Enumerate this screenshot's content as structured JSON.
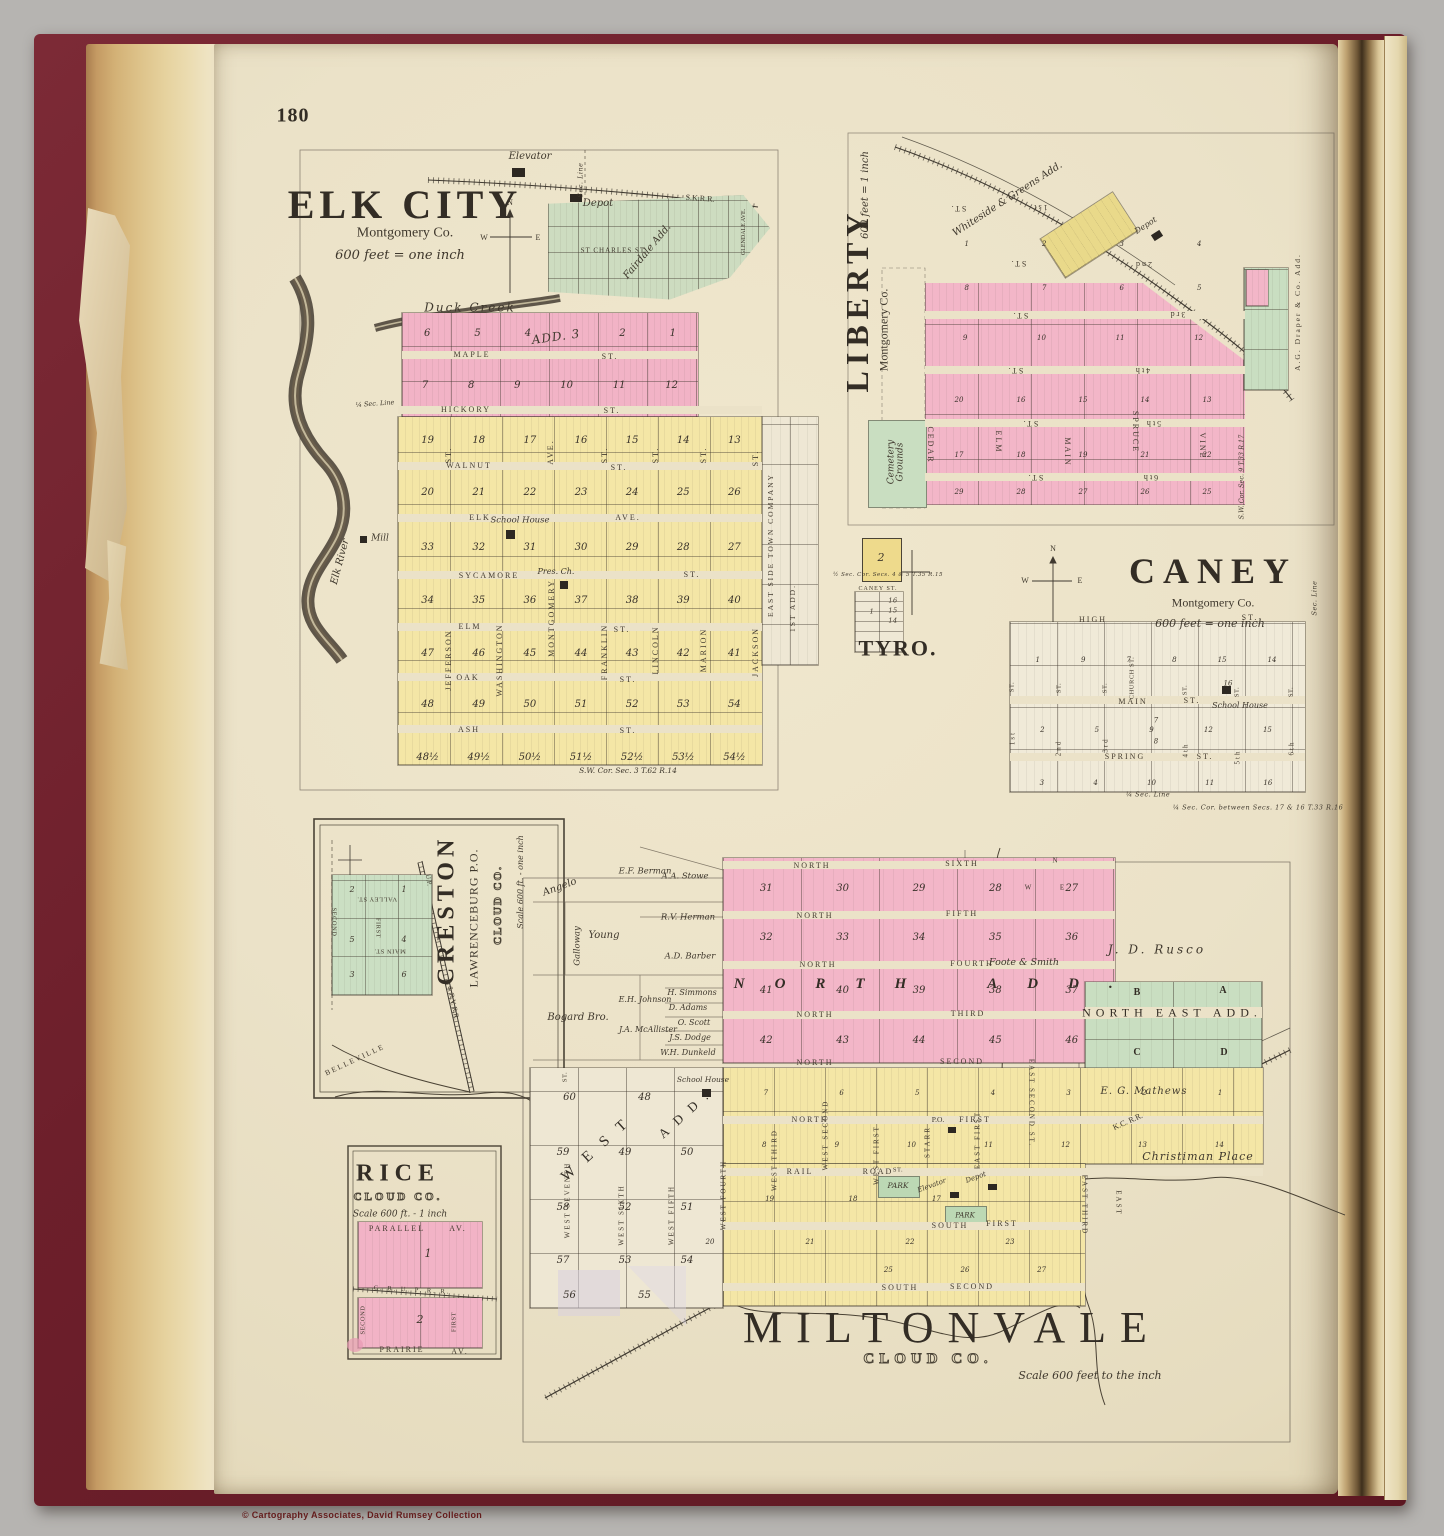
{
  "page": {
    "number": "180",
    "copyright": "© Cartography Associates, David Rumsey Collection"
  },
  "elkcity": {
    "title": "ELK CITY",
    "county": "Montgomery Co.",
    "scale": "600 feet = one inch",
    "compass": {
      "n": "N",
      "w": "W",
      "e": "E"
    },
    "rr": "S.K.R.R.",
    "elevator": "Elevator",
    "depot": "Depot",
    "duck_creek": "Duck  Creek",
    "elk_river": "Elk River",
    "mill": "Mill",
    "add3": "ADD. 3",
    "sec_line": "Sec. Line",
    "qtr_sec": "¼ Sec. Line",
    "fairdale": "Fairdale Add.",
    "st_charles": "ST CHARLES ST.",
    "glendale": "GLENDALE AVE.",
    "school": "School House",
    "church": "Pres. Ch.",
    "east_side": "EAST SIDE TOWN COMPANY",
    "first_add": "1ST ADD.",
    "corner": "S.W. Cor. Sec. 3  T.62 R.14",
    "streets_h": [
      {
        "n": "MAPLE",
        "t": "ST."
      },
      {
        "n": "HICKORY",
        "t": "ST."
      },
      {
        "n": "WALNUT",
        "t": "ST."
      },
      {
        "n": "ELK",
        "t": "AVE."
      },
      {
        "n": "SYCAMORE",
        "t": "ST."
      },
      {
        "n": "ELM",
        "t": "ST."
      },
      {
        "n": "OAK",
        "t": "ST."
      },
      {
        "n": "ASH",
        "t": "ST."
      }
    ],
    "streets_v": [
      "JEFFERSON",
      "WASHINGTON",
      "MONTGOMERY",
      "FRANKLIN",
      "LINCOLN",
      "MARION",
      "JACKSON"
    ],
    "streets_v_upper": [
      "ST.",
      "AVE.",
      "ST.",
      "ST.",
      "ST.",
      "ST."
    ],
    "blocks_pink": [
      [
        "6",
        "5",
        "4",
        "",
        "2",
        "1"
      ],
      [
        "7",
        "8",
        "9",
        "10",
        "11",
        "12"
      ]
    ],
    "blocks_yellow": [
      [
        "19",
        "18",
        "17",
        "16",
        "15",
        "14",
        "13"
      ],
      [
        "20",
        "21",
        "22",
        "23",
        "24",
        "25",
        "26"
      ],
      [
        "33",
        "32",
        "31",
        "30",
        "29",
        "28",
        "27"
      ],
      [
        "34",
        "35",
        "36",
        "37",
        "38",
        "39",
        "40"
      ],
      [
        "47",
        "46",
        "45",
        "44",
        "43",
        "42",
        "41"
      ],
      [
        "48",
        "49",
        "50",
        "51",
        "52",
        "53",
        "54"
      ],
      [
        "48½",
        "49½",
        "50½",
        "51½",
        "52½",
        "53½",
        "54½"
      ]
    ]
  },
  "liberty": {
    "title": "LIBERTY",
    "county": "Montgomery Co.",
    "scale": "600 feet = 1 inch",
    "whiteside": "Whiteside & Greens Add.",
    "depot": "Depot",
    "cemetery": "Cemetery\nGrounds",
    "draper": "A.G. Draper & Co. Add.",
    "corner": "S.W. Cor. Sec. 9  T.33 R.17",
    "streets_h": [
      {
        "n": "1st",
        "t": "ST."
      },
      {
        "n": "2nd",
        "t": "ST."
      },
      {
        "n": "3rd",
        "t": "ST."
      },
      {
        "n": "4th",
        "t": "ST."
      },
      {
        "n": "5th",
        "t": "ST."
      },
      {
        "n": "6th",
        "t": "ST."
      }
    ],
    "streets_v": [
      "CEDAR",
      "ELM",
      "MAIN",
      "SPRUCE",
      "VINE"
    ],
    "blocks": [
      [
        "1",
        "2",
        "3",
        "4"
      ],
      [
        "8",
        "7",
        "6",
        "5"
      ],
      [
        "9",
        "10",
        "11",
        "12"
      ],
      [
        "20",
        "16",
        "15",
        "14",
        "13"
      ],
      [
        "17",
        "18",
        "19",
        "21",
        "22"
      ],
      [
        "29",
        "28",
        "27",
        "26",
        "25"
      ]
    ]
  },
  "tyro": {
    "title": "TYRO.",
    "street": "CANEY ST.",
    "corner": "½ Sec. Cor. Secs. 4 & 5  T.35 R.15",
    "block": "2",
    "lots": [
      "1",
      "16",
      "15",
      "14"
    ]
  },
  "caney": {
    "title": "CANEY",
    "county": "Montgomery Co.",
    "scale": "600 feet = one inch",
    "compass": {
      "n": "N",
      "w": "W",
      "e": "E"
    },
    "school": "School House",
    "sec_line": "Sec. Line",
    "qtr_line": "¼ Sec. Line",
    "corner": "¼ Sec. Cor. between Secs. 17 & 16  T.33 R.16",
    "st_label": "ST.",
    "church_st": "CHURCH ST.",
    "streets_h": [
      {
        "n": "HIGH",
        "t": "ST."
      },
      {
        "n": "MAIN",
        "t": "ST."
      },
      {
        "n": "SPRING",
        "t": "ST."
      }
    ],
    "streets_v": [
      "1st",
      "2nd",
      "3rd",
      "4th",
      "5th",
      "6th"
    ],
    "blocks": [
      [
        "1",
        "9",
        "7",
        "8",
        "15",
        "14"
      ],
      [
        "2",
        "5",
        "9",
        "12",
        "15"
      ],
      [
        "3",
        "4",
        "10",
        "11",
        "16"
      ]
    ],
    "extra_blocks": [
      "16",
      "7",
      "8"
    ]
  },
  "creston": {
    "title": "CRESTON",
    "subtitle": "LAWRENCEBURG P.O.",
    "county": "CLOUD CO.",
    "scale": "Scale 600 ft. - one inch",
    "streets": {
      "valley": "VALLEY ST.",
      "main": "MAIN ST.",
      "first": "FIRST",
      "second": "SECOND"
    },
    "rr1": "U.P.",
    "rr2": "J. & R.V. R.R.",
    "belleville": "BELLEVILLE",
    "blocks": [
      "2",
      "1",
      "5",
      "4",
      "3",
      "6"
    ]
  },
  "rice": {
    "title": "RICE",
    "county": "CLOUD CO.",
    "scale": "Scale 600 ft. - 1 inch",
    "parallel": {
      "n": "PARALLEL",
      "t": "AV."
    },
    "prairie": {
      "n": "PRAIRIE",
      "t": "AV."
    },
    "second": "SECOND",
    "first": "FIRST",
    "rr": "C. B. U. P.  R. R.",
    "blocks": [
      "1",
      "2"
    ]
  },
  "miltonvale": {
    "title": "MILTONVALE",
    "county": "CLOUD CO.",
    "scale": "Scale 600 feet to the inch",
    "north_add": {
      "n": "NORTH",
      "t": "ADD."
    },
    "north_east_add": "NORTH EAST ADD.",
    "west_add": {
      "n": "WEST",
      "t": "ADD."
    },
    "compass": {
      "n": "N",
      "w": "W",
      "e": "E"
    },
    "owners": {
      "angelo": "Angelo",
      "berman": "E.F. Berman",
      "stowe": "A.A. Stowe",
      "herman": "R.V. Herman",
      "young": "Young",
      "galloway": "Galloway",
      "barber": "A.D. Barber",
      "bogard": "Bogard Bro.",
      "johnson": "E.H. Johnson",
      "simmons": "H. Simmons",
      "adams": "D. Adams",
      "mcallister": "J.A. McAllister",
      "scott": "O. Scott",
      "dodge": "J.S. Dodge",
      "dunkeld": "W.H. Dunkeld",
      "rusco": "J. D. Rusco",
      "foote": "Foote & Smith",
      "mathews": "E. G. Mathews",
      "christiman": "Christiman Place"
    },
    "rr": "K.C. R.R.",
    "po": "P.O.",
    "elevator": "Elevator",
    "depot": "Depot",
    "park": "PARK",
    "park_st": "ST.",
    "school": "School House",
    "streets_h": [
      {
        "n": "NORTH",
        "t": "SIXTH"
      },
      {
        "n": "NORTH",
        "t": "FIFTH"
      },
      {
        "n": "NORTH",
        "t": "FOURTH"
      },
      {
        "n": "NORTH",
        "t": "THIRD"
      },
      {
        "n": "NORTH",
        "t": "SECOND"
      },
      {
        "n": "NORTH",
        "t": "FIRST"
      },
      {
        "n": "RAIL",
        "t": "ROAD"
      },
      {
        "n": "SOUTH",
        "t": "FIRST"
      },
      {
        "n": "SOUTH",
        "t": "SECOND"
      }
    ],
    "streets_v": [
      "ST.",
      "WEST SEVENTH",
      "WEST SIXTH",
      "WEST FIFTH",
      "WEST FOURTH",
      "WEST THIRD",
      "WEST SECOND",
      "WEST FIRST",
      "STARR",
      "EAST FIRST",
      "EAST SECOND ST.",
      "EAST THIRD",
      "EAST"
    ],
    "ne_blocks": [
      "B",
      "A",
      "C",
      "D"
    ],
    "blocks_north": [
      [
        "31",
        "30",
        "29",
        "28",
        "27"
      ],
      [
        "32",
        "33",
        "34",
        "35",
        "36"
      ],
      [
        "41",
        "40",
        "39",
        "38",
        "37"
      ],
      [
        "42",
        "43",
        "44",
        "45",
        "46"
      ]
    ],
    "blocks_yellow": [
      [
        "7",
        "6",
        "5",
        "4",
        "3",
        "2",
        "1"
      ],
      [
        "8",
        "9",
        "10",
        "11",
        "12",
        "13",
        "14"
      ],
      [
        "19",
        "18",
        "17"
      ],
      [
        "20",
        "21",
        "22",
        "23"
      ],
      [
        "25",
        "26",
        "27"
      ]
    ],
    "blocks_west": [
      [
        "60",
        "48"
      ],
      [
        "59",
        "49",
        "50"
      ],
      [
        "58",
        "52",
        "51"
      ],
      [
        "57",
        "53",
        "54"
      ],
      [
        "56",
        "55"
      ]
    ]
  }
}
